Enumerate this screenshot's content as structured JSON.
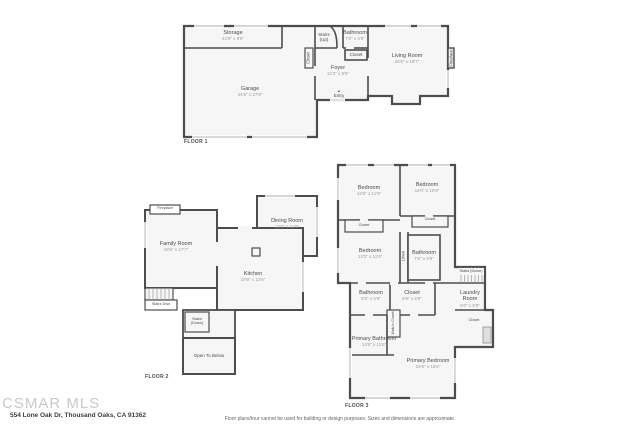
{
  "page": {
    "background": "#ffffff",
    "wall_color": "#4d4d4d",
    "floor_fill": "#f6f6f6",
    "window_color": "#c9c9c9"
  },
  "footer": {
    "watermark": "CSMAR MLS",
    "address": "554 Lone Oak Dr, Thousand Oaks, CA 91362",
    "disclaimer": "Floor plans/tour cannot be used for building or design purposes. Sizes and dimensions are approximate."
  },
  "floor1": {
    "label": "FLOOR 1",
    "rooms": {
      "storage": {
        "name": "Storage",
        "dims": "44'9\" x 8'6\""
      },
      "garage": {
        "name": "Garage",
        "dims": "44'6\" x 27'9\""
      },
      "stairs": {
        "name": "Stairs (Up)"
      },
      "bathroom": {
        "name": "Bathroom",
        "dims": "7'0\" x 4'9\""
      },
      "closet_hall": {
        "name": "Closet"
      },
      "closet_bath": {
        "name": "Closet"
      },
      "foyer": {
        "name": "Foyer",
        "dims": "12'3\" x 9'6\""
      },
      "entry": {
        "name": "Entry",
        "arrow": "▲"
      },
      "living": {
        "name": "Living Room",
        "dims": "26'6\" x 18'7\""
      },
      "fireplace": {
        "name": "Fireplace"
      }
    }
  },
  "floor2": {
    "label": "FLOOR 2",
    "rooms": {
      "fireplace": {
        "name": "Fireplace"
      },
      "family": {
        "name": "Family Room",
        "dims": "19'6\" x 17'7\""
      },
      "dining": {
        "name": "Dining Room",
        "dims": "13'6\" x 11'6\""
      },
      "kitchen": {
        "name": "Kitchen",
        "dims": "19'9\" x 13'6\""
      },
      "stairs_dwn": {
        "name": "Stairs Dwn"
      },
      "stairs_down": {
        "name": "Stairs (Down)"
      },
      "open_below": {
        "name": "Open To Below"
      }
    }
  },
  "floor3": {
    "label": "FLOOR 3",
    "rooms": {
      "bedroom1": {
        "name": "Bedroom",
        "dims": "13'6\" x 11'6\""
      },
      "bedroom2": {
        "name": "Bedroom",
        "dims": "14'0\" x 10'9\""
      },
      "closet_left": {
        "name": "Closet"
      },
      "closet_right": {
        "name": "Closet"
      },
      "bedroom3": {
        "name": "Bedroom",
        "dims": "13'3\" x 11'9\""
      },
      "linen": {
        "name": "Linen"
      },
      "bathroom_mid": {
        "name": "Bathroom",
        "dims": "7'6\" x 6'9\""
      },
      "stairs_down": {
        "name": "Stairs (Down)"
      },
      "bathroom_low": {
        "name": "Bathroom",
        "dims": "8'0\" x 5'9\""
      },
      "closet_low": {
        "name": "Closet",
        "dims": "8'6\" x 5'9\""
      },
      "laundry": {
        "name": "Laundry Room",
        "dims": "6'0\" x 5'9\""
      },
      "closet_r2": {
        "name": "Closet"
      },
      "walkin": {
        "name": "Walk-in Closet"
      },
      "primary_bath": {
        "name": "Primary Bathroom",
        "dims": "14'6\" x 11'6\""
      },
      "primary_bed": {
        "name": "Primary Bedroom",
        "dims": "19'6\" x 16'6\""
      }
    }
  }
}
